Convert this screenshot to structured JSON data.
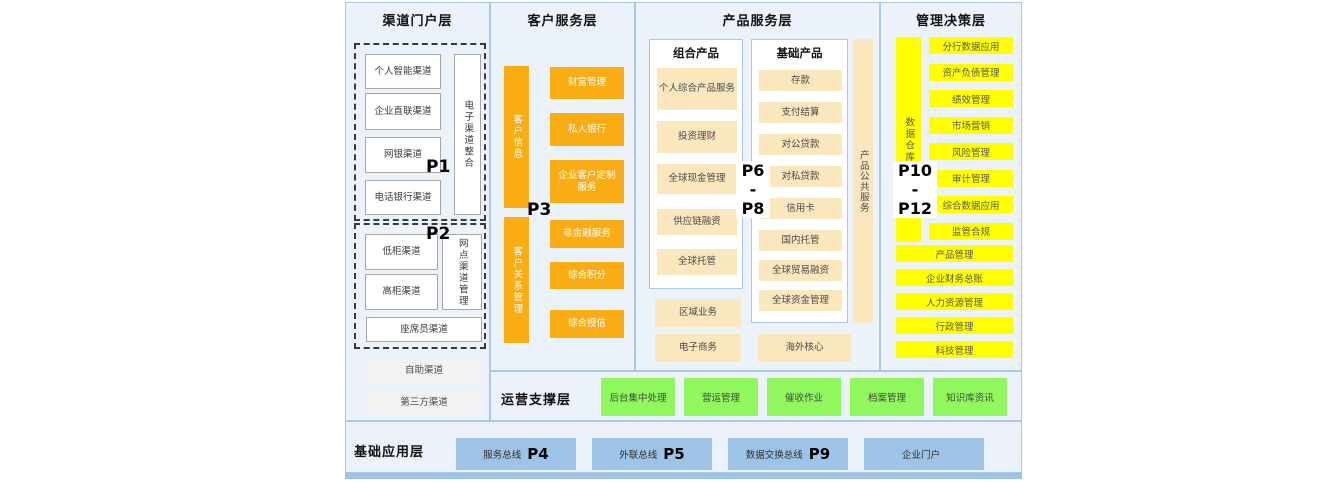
{
  "channel": {
    "title": "渠道门户层",
    "p1": "P1",
    "p2": "P2",
    "group1_items": [
      "个人智能渠道",
      "企业直联渠道",
      "网银渠道",
      "电话银行渠道"
    ],
    "group1_vertical": "电子渠道整合",
    "group2_items": [
      "低柜渠道",
      "高柜渠道"
    ],
    "group2_vertical": "网点渠道管理",
    "group2_wide": "座席员渠道",
    "extra_items": [
      "自助渠道",
      "第三方渠道"
    ]
  },
  "customer": {
    "title": "客户服务层",
    "p3": "P3",
    "bar_top": "客户信息",
    "bar_bottom": "客户关系管理",
    "boxes": [
      "财富管理",
      "私人银行",
      "企业客户定制服务",
      "非金融服务",
      "综合积分",
      "综合授信"
    ]
  },
  "product": {
    "title": "产品服务层",
    "p_range": [
      "P6",
      "-",
      "P8"
    ],
    "combo_title": "组合产品",
    "combo_items": [
      "个人综合产品服务",
      "投资理财",
      "全球现金管理",
      "供应链融资",
      "全球托管"
    ],
    "combo_extra": [
      "区域业务",
      "电子商务"
    ],
    "basic_title": "基础产品",
    "basic_items": [
      "存款",
      "支付结算",
      "对公贷款",
      "对私贷款",
      "信用卡",
      "国内托管",
      "全球贸易融资",
      "全球资金管理"
    ],
    "overseas": "海外核心",
    "vertical": "产品公共服务"
  },
  "management": {
    "title": "管理决策层",
    "p_range": [
      "P10",
      "-",
      "P12"
    ],
    "vertical": "数据仓库",
    "small_boxes": [
      "分行数据应用",
      "资产负债管理",
      "绩效管理",
      "市场营销",
      "风险管理",
      "审计管理",
      "综合数据应用",
      "监管合规"
    ],
    "wide_boxes": [
      "产品管理",
      "企业财务总账",
      "人力资源管理",
      "行政管理",
      "科技管理"
    ]
  },
  "ops": {
    "title": "运营支撑层",
    "items": [
      "后台集中处理",
      "营运管理",
      "催收作业",
      "档案管理",
      "知识库资讯"
    ]
  },
  "base": {
    "title": "基础应用层",
    "items": [
      {
        "label": "服务总线",
        "p": "P4"
      },
      {
        "label": "外联总线",
        "p": "P5"
      },
      {
        "label": "数据交换总线",
        "p": "P9"
      },
      {
        "label": "企业门户",
        "p": ""
      }
    ]
  },
  "colors": {
    "orange": "#FAAC15",
    "cream": "#FBE7BE",
    "yellow": "#FFFF00",
    "green": "#90F85E",
    "blue": "#9DC3E6",
    "panel_bg": "#ECF2FA",
    "panel_border": "#A9C7E8"
  }
}
